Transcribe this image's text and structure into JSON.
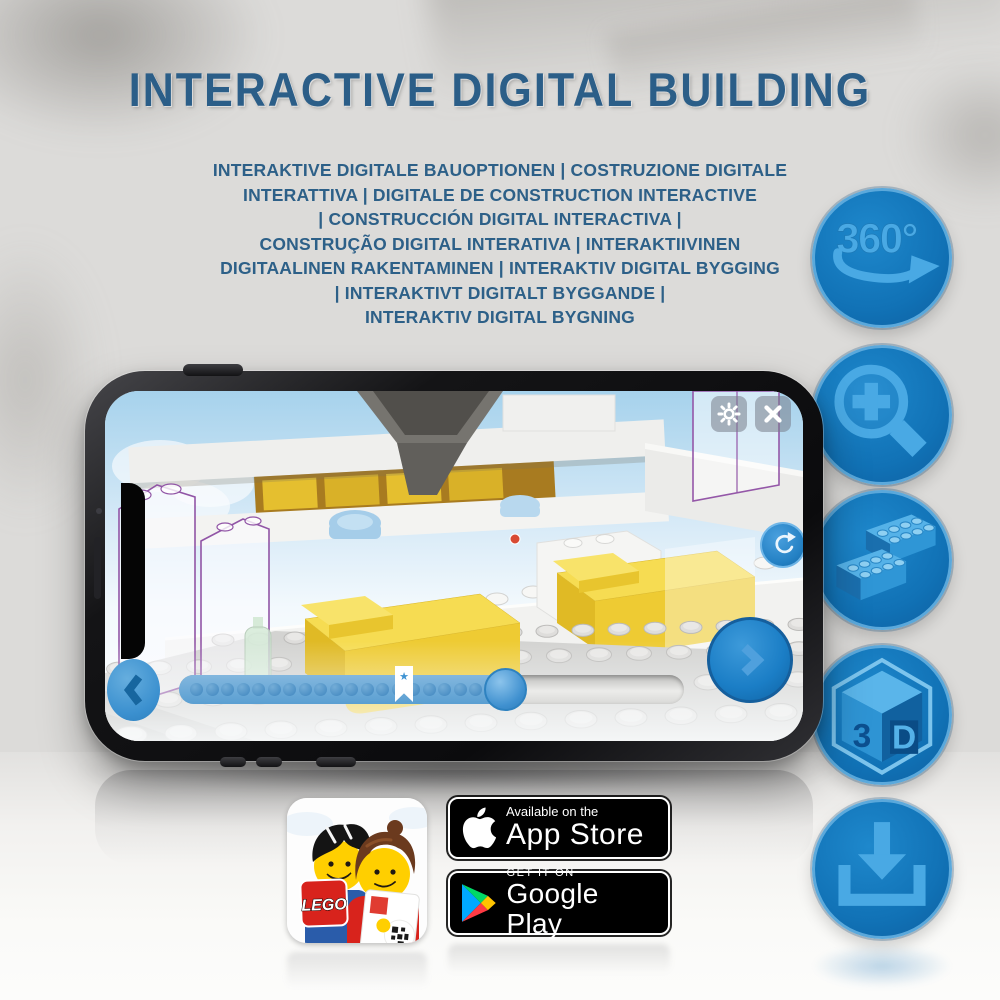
{
  "header": {
    "title": "INTERACTIVE DIGITAL BUILDING",
    "subtitle_lines": [
      "INTERAKTIVE DIGITALE BAUOPTIONEN | COSTRUZIONE DIGITALE",
      "INTERATTIVA | DIGITALE DE CONSTRUCTION INTERACTIVE",
      "| CONSTRUCCIÓN DIGITAL INTERACTIVA |",
      "CONSTRUÇÃO DIGITAL INTERATIVA | INTERAKTIIVINEN",
      "DIGITAALINEN RAKENTAMINEN | INTERAKTIV DIGITAL BYGGING",
      "| INTERAKTIVT DIGITALT BYGGANDE |",
      "INTERAKTIV DIGITAL BYGNING"
    ]
  },
  "feature_badges": {
    "rotate_360": {
      "label": "360°"
    },
    "cube_3d": {
      "left": "3",
      "right": "D"
    }
  },
  "app_icon": {
    "logo": "LEGO"
  },
  "store_badges": {
    "app_store": {
      "tagline": "Available on the",
      "name": "App Store"
    },
    "google_play": {
      "tagline": "GET IT ON",
      "name": "Google Play"
    }
  },
  "colors": {
    "title_blue": "#2b5e88",
    "feature_circle_blue": "#1377be",
    "feature_glyph_blue": "#49a9e4",
    "app_ui_blue": "#2e8fd0",
    "lego_brick_yellow": "#f2d038",
    "lego_red": "#d8231c",
    "ghost_outline_purple": "#9457a8",
    "play_cyan": "#00a8ff",
    "play_green": "#00d967",
    "play_yellow": "#ffc400",
    "play_red": "#ff3a44"
  }
}
